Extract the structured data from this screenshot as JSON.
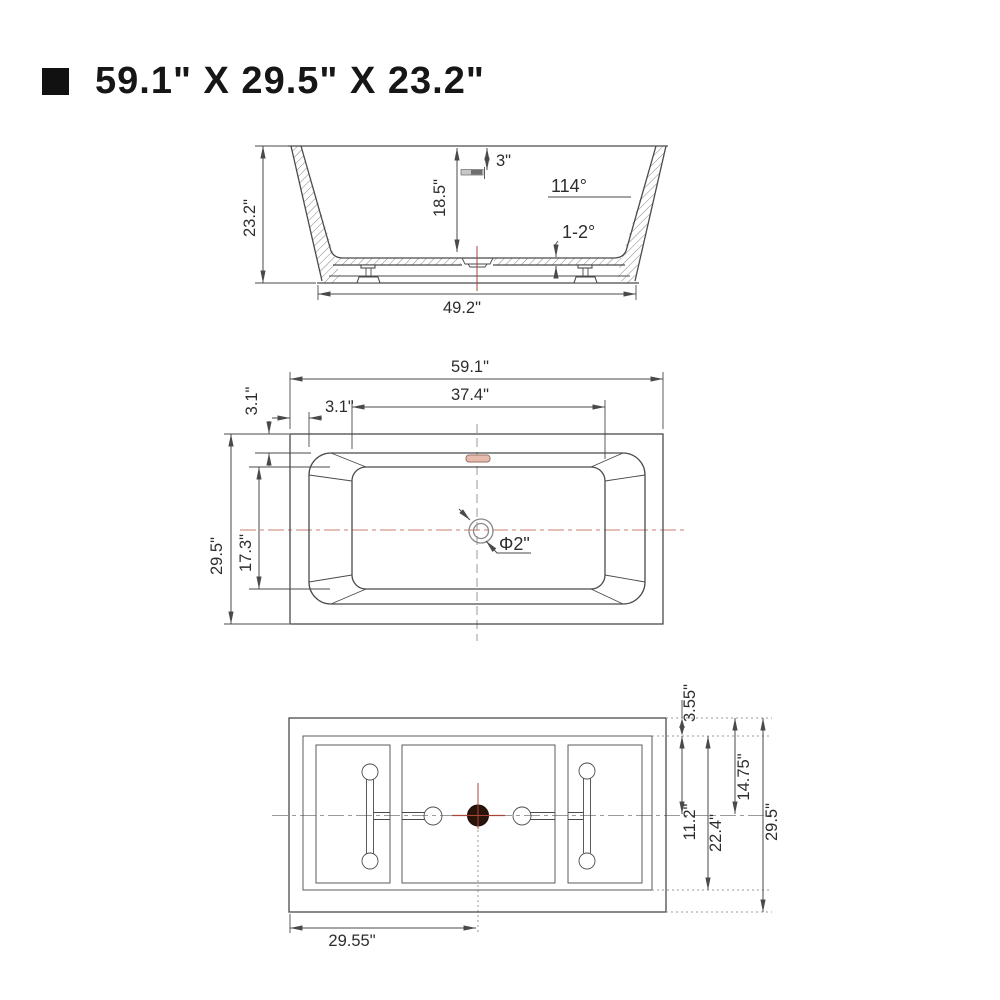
{
  "title": {
    "text": "59.1\" X 29.5\" X 23.2\""
  },
  "colors": {
    "line": "#4a4a4a",
    "text": "#2d2d2d",
    "centerline_pink": "#d4988c",
    "accent_red": "#a94438",
    "overflow_fill": "#e6bcae",
    "overflow_stroke": "#9c7265",
    "drain_fill": "#2a1309",
    "gray": "#9a9a9a",
    "hatch": "#787878"
  },
  "side_view": {
    "height": "23.2\"",
    "depth": "18.5\"",
    "overflow_drop": "3\"",
    "wall_angle": "114°",
    "bottom_slope": "1-2°",
    "base_length": "49.2\""
  },
  "plan_view": {
    "length": "59.1\"",
    "floor_length": "37.4\"",
    "rim_left": "3.1\"",
    "rim_top": "3.1\"",
    "width": "29.5\"",
    "floor_width": "17.3\"",
    "drain_diameter": "Φ2\""
  },
  "bottom_view": {
    "top_offset": "3.55\"",
    "inner_to_center": "11.2\"",
    "inner_width": "22.4\"",
    "edge_to_center": "14.75\"",
    "width": "29.5\"",
    "half_length": "29.55\""
  }
}
